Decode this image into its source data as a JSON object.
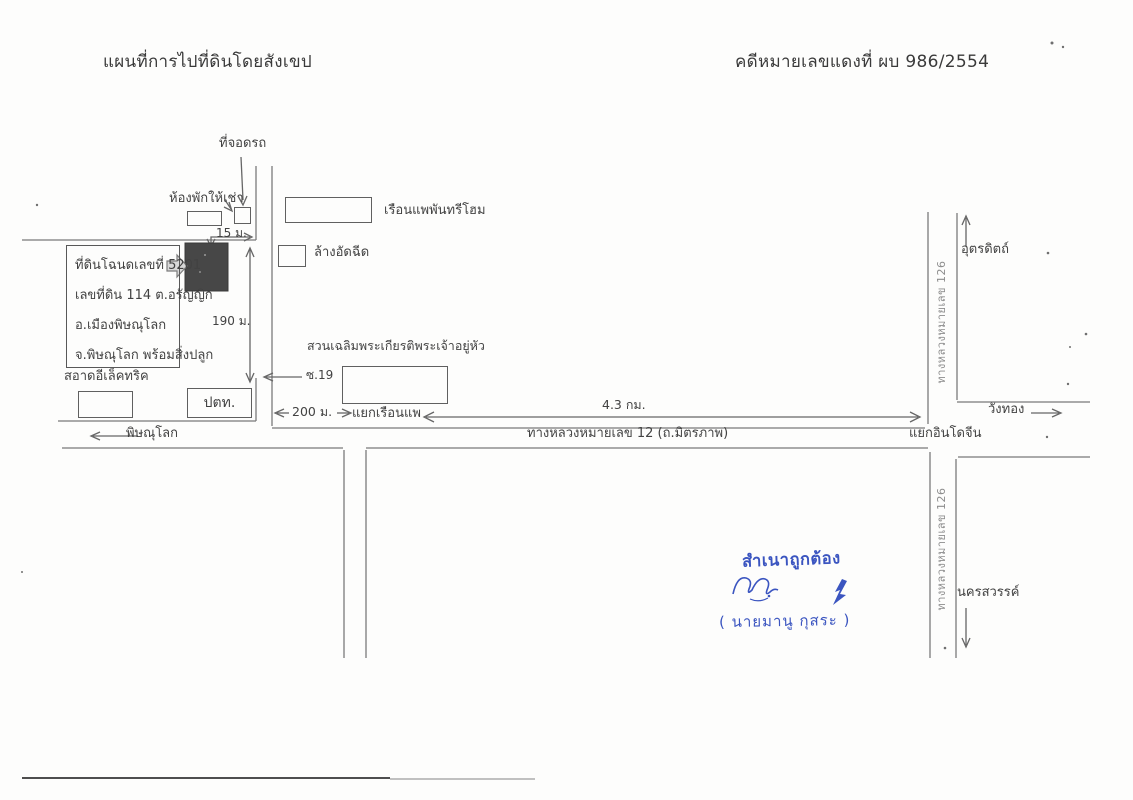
{
  "colors": {
    "ink": "#3f3f3f",
    "road_line": "#7a7a7a",
    "stamp_blue": "#3b55c0",
    "plot_fill": "#474747"
  },
  "header": {
    "title": "แผนที่การไปที่ดินโดยสังเขป",
    "case_number": "คดีหมายเลขแดงที่  ผบ 986/2554"
  },
  "map": {
    "places": {
      "parking": "ที่จอดรถ",
      "rooms_for_rent": "ห้องพักให้เช่า",
      "raft_house": "เรือนแพพันทรีโฮม",
      "car_wash": "ล้างอัดฉีด",
      "royal_park": "สวนเฉลิมพระเกียรติพระเจ้าอยู่หัว",
      "electric_shop": "สอาดอีเล็คทริค",
      "gas_station": "ปตท.",
      "soi": "ซ.19",
      "raft_junction": "แยกเรือนแพ",
      "indochina_junction": "แยกอินโดจีน",
      "phitsanulok": "พิษณุโลก",
      "wang_thong": "วังทอง",
      "uttaradit": "อุตรดิตถ์",
      "nakhon_sawan": "นครสวรรค์",
      "highway_12": "ทางหลวงหมายเลข 12 (ถ.มิตรภาพ)",
      "highway_126": "ทางหลวงหมายเลข 126"
    },
    "land_info": {
      "lines": [
        "ที่ดินโฉนดเลขที่ 5201",
        "เลขที่ดิน 114 ต.อรัญญิก",
        "อ.เมืองพิษณุโลก",
        "จ.พิษณุโลก พร้อมสิ่งปลูก"
      ]
    },
    "measurements": {
      "frontage": "15 ม.",
      "depth": "190 ม.",
      "to_junction": "200 ม.",
      "to_indochina": "4.3 กม."
    }
  },
  "stamp": {
    "certified": "สำเนาถูกต้อง",
    "name": "( นายมานู  กุสระ )"
  }
}
